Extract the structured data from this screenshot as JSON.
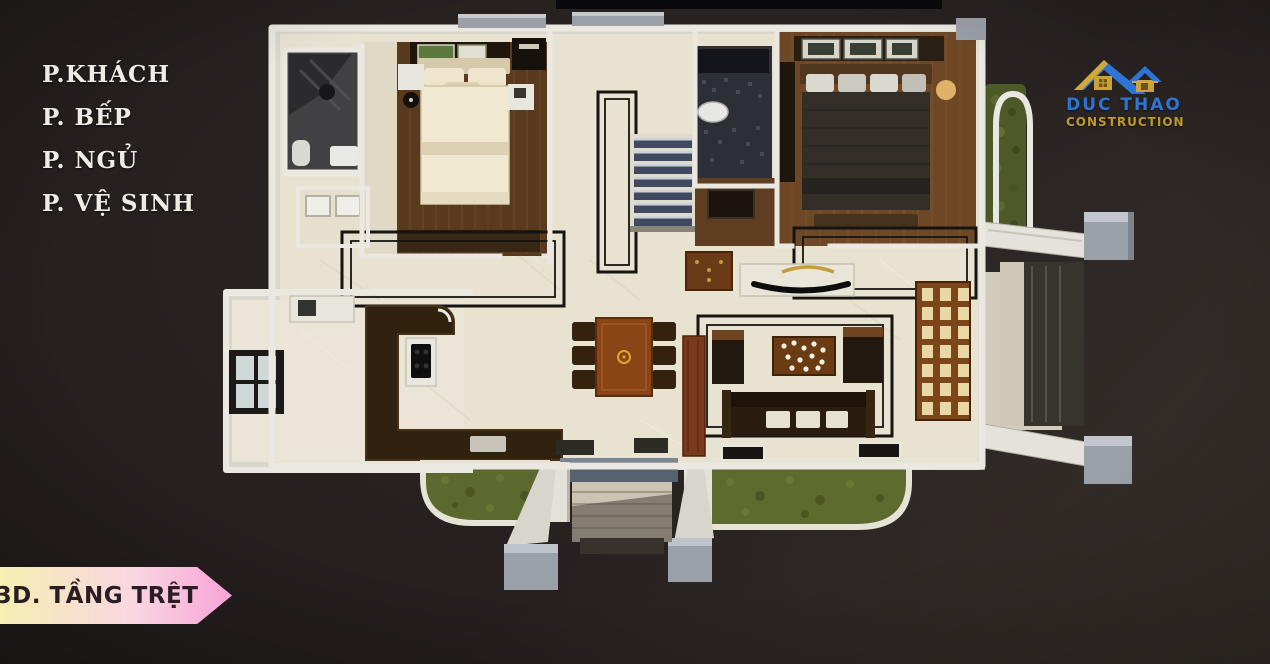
{
  "legend": {
    "items": [
      "P.KHÁCH",
      "P. BẾP",
      "P. NGỦ",
      "P. VỆ SINH"
    ]
  },
  "logo": {
    "name": "DUC THAO",
    "subtitle": "CONSTRUCTION",
    "icon": "twin-house-roofs-icon"
  },
  "ribbon": {
    "label": "3D. TẦNG TRỆT"
  },
  "colors": {
    "legend-text": "#efece5",
    "logo-blue": "#2e74d2",
    "logo-gold": "#bf9830",
    "ribbon-start": "#f6eeb2",
    "ribbon-mid": "#f9d6e2",
    "ribbon-end": "#f8a3d7",
    "ribbon-text": "#2a1d24",
    "background-dark": "#221e1d",
    "background-light": "#37302c"
  }
}
